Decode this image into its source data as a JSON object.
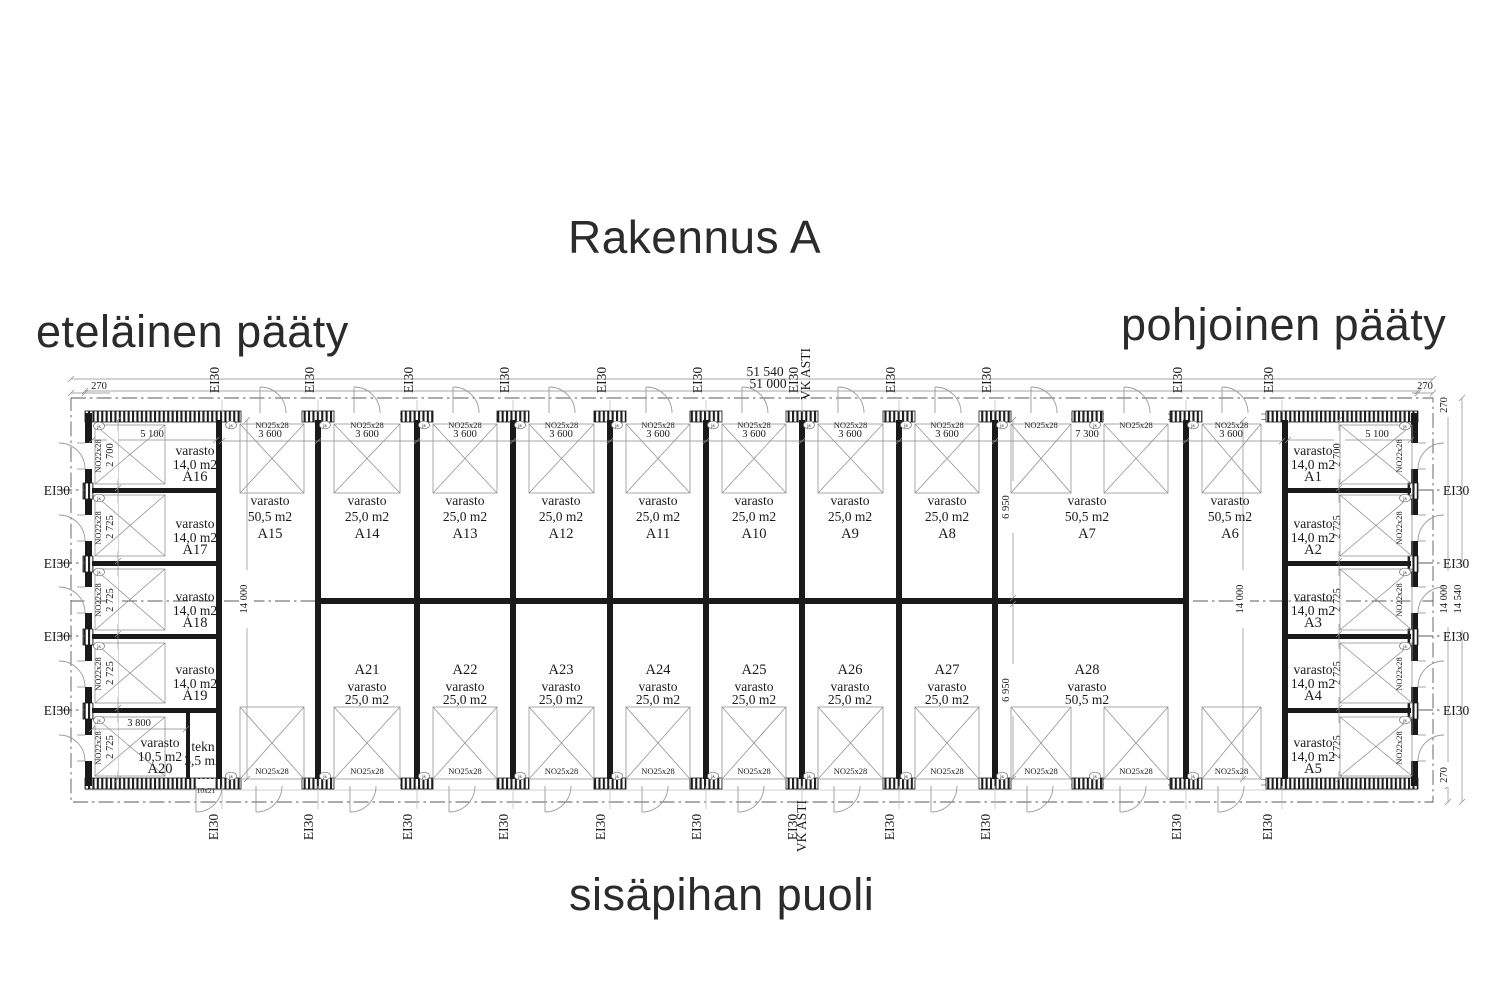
{
  "title": "Rakennus A",
  "corner_labels": {
    "south": "eteläinen pääty",
    "north": "pohjoinen pääty",
    "courtyard": "sisäpihan puoli"
  },
  "fire_rating": "EI30",
  "vk_label": "VK ASTI",
  "room_word": "varasto",
  "overall": {
    "outer_width": "51 540",
    "inner_width": "51 000",
    "inner_height": "14 000",
    "outer_height": "14 540",
    "offset": "270"
  },
  "dims": {
    "bay": "3 600",
    "double_bay": "7 300",
    "left_width": "5 100",
    "first_depth": "2 700",
    "depth": "2 725",
    "a20_width": "3 800",
    "col_height": "14 000",
    "half_height": "6 950"
  },
  "doors": {
    "overhead": "NO25x28",
    "side": "NO22x28",
    "tekn_door": "10x21",
    "jamb_mark": "js"
  },
  "units": {
    "top": [
      {
        "id": "A15",
        "area": "50,5 m2"
      },
      {
        "id": "A14",
        "area": "25,0 m2"
      },
      {
        "id": "A13",
        "area": "25,0 m2"
      },
      {
        "id": "A12",
        "area": "25,0 m2"
      },
      {
        "id": "A11",
        "area": "25,0 m2"
      },
      {
        "id": "A10",
        "area": "25,0 m2"
      },
      {
        "id": "A9",
        "area": "25,0 m2"
      },
      {
        "id": "A8",
        "area": "25,0 m2"
      },
      {
        "id": "A7",
        "area": "50,5 m2"
      },
      {
        "id": "A6",
        "area": "50,5 m2"
      }
    ],
    "bottom": [
      {
        "id": "A21",
        "area": "25,0 m2"
      },
      {
        "id": "A22",
        "area": "25,0 m2"
      },
      {
        "id": "A23",
        "area": "25,0 m2"
      },
      {
        "id": "A24",
        "area": "25,0 m2"
      },
      {
        "id": "A25",
        "area": "25,0 m2"
      },
      {
        "id": "A26",
        "area": "25,0 m2"
      },
      {
        "id": "A27",
        "area": "25,0 m2"
      },
      {
        "id": "A28",
        "area": "50,5 m2"
      }
    ],
    "left": [
      {
        "id": "A16",
        "area": "14,0 m2"
      },
      {
        "id": "A17",
        "area": "14,0 m2"
      },
      {
        "id": "A18",
        "area": "14,0 m2"
      },
      {
        "id": "A19",
        "area": "14,0 m2"
      },
      {
        "id": "A20",
        "area": "10,5 m2"
      },
      {
        "id": "tekn",
        "area": "3,5 m2"
      }
    ],
    "right": [
      {
        "id": "A1",
        "area": "14,0 m2"
      },
      {
        "id": "A2",
        "area": "14,0 m2"
      },
      {
        "id": "A3",
        "area": "14,0 m2"
      },
      {
        "id": "A4",
        "area": "14,0 m2"
      },
      {
        "id": "A5",
        "area": "14,0 m2"
      }
    ]
  }
}
